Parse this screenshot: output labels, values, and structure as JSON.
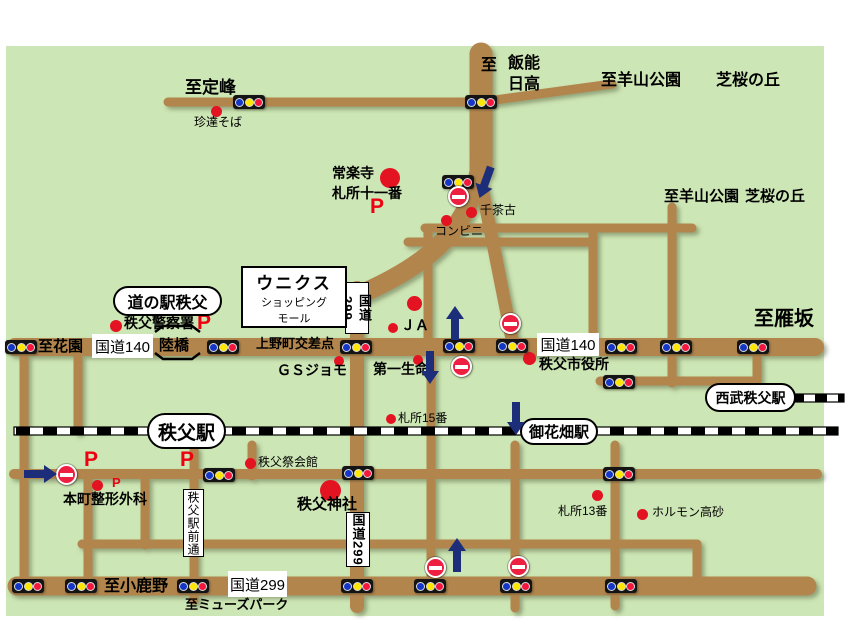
{
  "colors": {
    "map_bg": "#cde6b5",
    "road": "#b2854e",
    "rail": "#000000",
    "poi_red": "#e31322",
    "parking_red": "#ee0010",
    "arrow_navy": "#1c2d7a",
    "signal_blue": "#1437c8",
    "signal_yellow": "#ffe800",
    "signal_red": "#f5173c"
  },
  "map": {
    "directions": {
      "sadamine": "至定峰",
      "to": "至",
      "hanno": "飯能",
      "hidaka": "日高",
      "yamakoen": "至羊山公園",
      "shibazakura": "芝桜の丘",
      "karisaka": "至雁坂",
      "hanazono": "至花園",
      "ogano": "至小鹿野",
      "musepark": "至ミューズパーク"
    },
    "roads": {
      "kokudo140": "国道140",
      "kokudo299": "国道299",
      "rikkyo": "陸橋",
      "uenomachi": "上野町交差点",
      "ekimaedori": "秩父駅前通"
    },
    "stations": {
      "michinoeki": "道の駅秩父",
      "chichibu": "秩父駅",
      "ohanabatake": "御花畑駅",
      "seibu_chichibu": "西武秩父駅"
    },
    "pois": {
      "chintatsu": "珍達そば",
      "jorakuji": "常楽寺",
      "fudasho11": "札所十一番",
      "senchako": "千茶古",
      "konbini": "コンビニ",
      "police": "秩父警察署",
      "unicus1": "ウニクス",
      "unicus2": "ショッピング",
      "unicus3": "モール",
      "ja": "ＪＡ",
      "gsjomo": "ＧＳジョモ",
      "daiichi": "第一生命",
      "shiyakusho": "秩父市役所",
      "fudasho15": "札所15番",
      "saikaikan": "秩父祭会館",
      "jinja": "秩父神社",
      "honcho": "本町整形外科",
      "fudasho13": "札所13番",
      "horumon": "ホルモン高砂"
    },
    "parking_label": "P"
  }
}
